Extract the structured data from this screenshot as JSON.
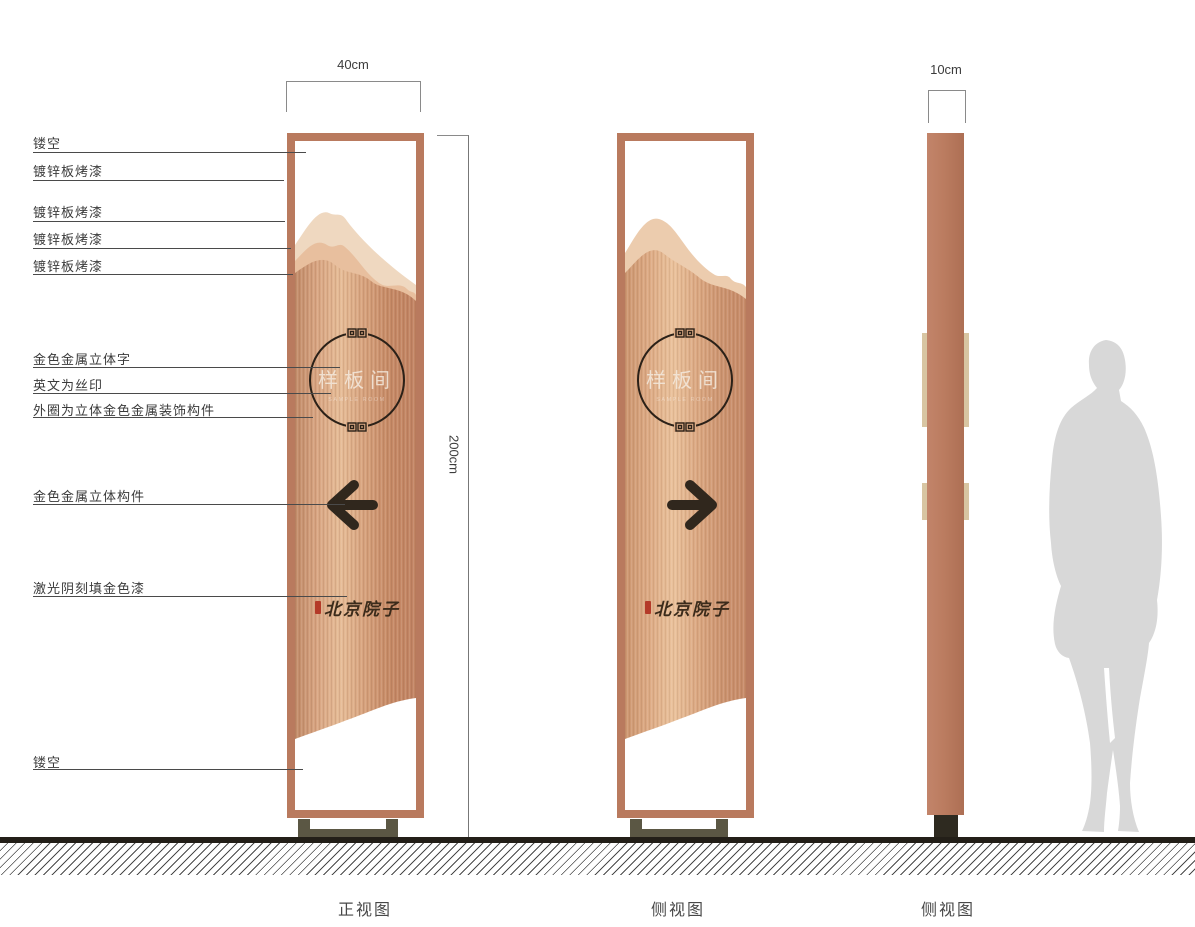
{
  "callouts": [
    {
      "text": "镂空"
    },
    {
      "text": "镀锌板烤漆"
    },
    {
      "text": "镀锌板烤漆"
    },
    {
      "text": "镀锌板烤漆"
    },
    {
      "text": "镀锌板烤漆"
    },
    {
      "text": "金色金属立体字"
    },
    {
      "text": "英文为丝印"
    },
    {
      "text": "外圈为立体金色金属装饰构件"
    },
    {
      "text": "金色金属立体构件"
    },
    {
      "text": "激光阴刻填金色漆"
    },
    {
      "text": "镂空"
    }
  ],
  "dimensions": {
    "front_width": "40cm",
    "height": "200cm",
    "side_depth": "10cm"
  },
  "sign": {
    "circle_text": "样板间",
    "english_subtitle": "SAMPLE ROOM",
    "brand_text": "北京院子"
  },
  "views": {
    "front": "正视图",
    "side": "侧视图",
    "profile": "侧视图"
  },
  "colors": {
    "frame_copper": "#b97a5e",
    "body_wood_light": "#e6bc97",
    "body_wood_dark": "#c08365",
    "mountain_back": "#efd8c0",
    "mountain_front": "#e8bf9e",
    "component_dark": "#30271d",
    "seal_red": "#b43a28",
    "base_olive": "#5b5744",
    "silhouette_gray": "#d8d8d8"
  }
}
